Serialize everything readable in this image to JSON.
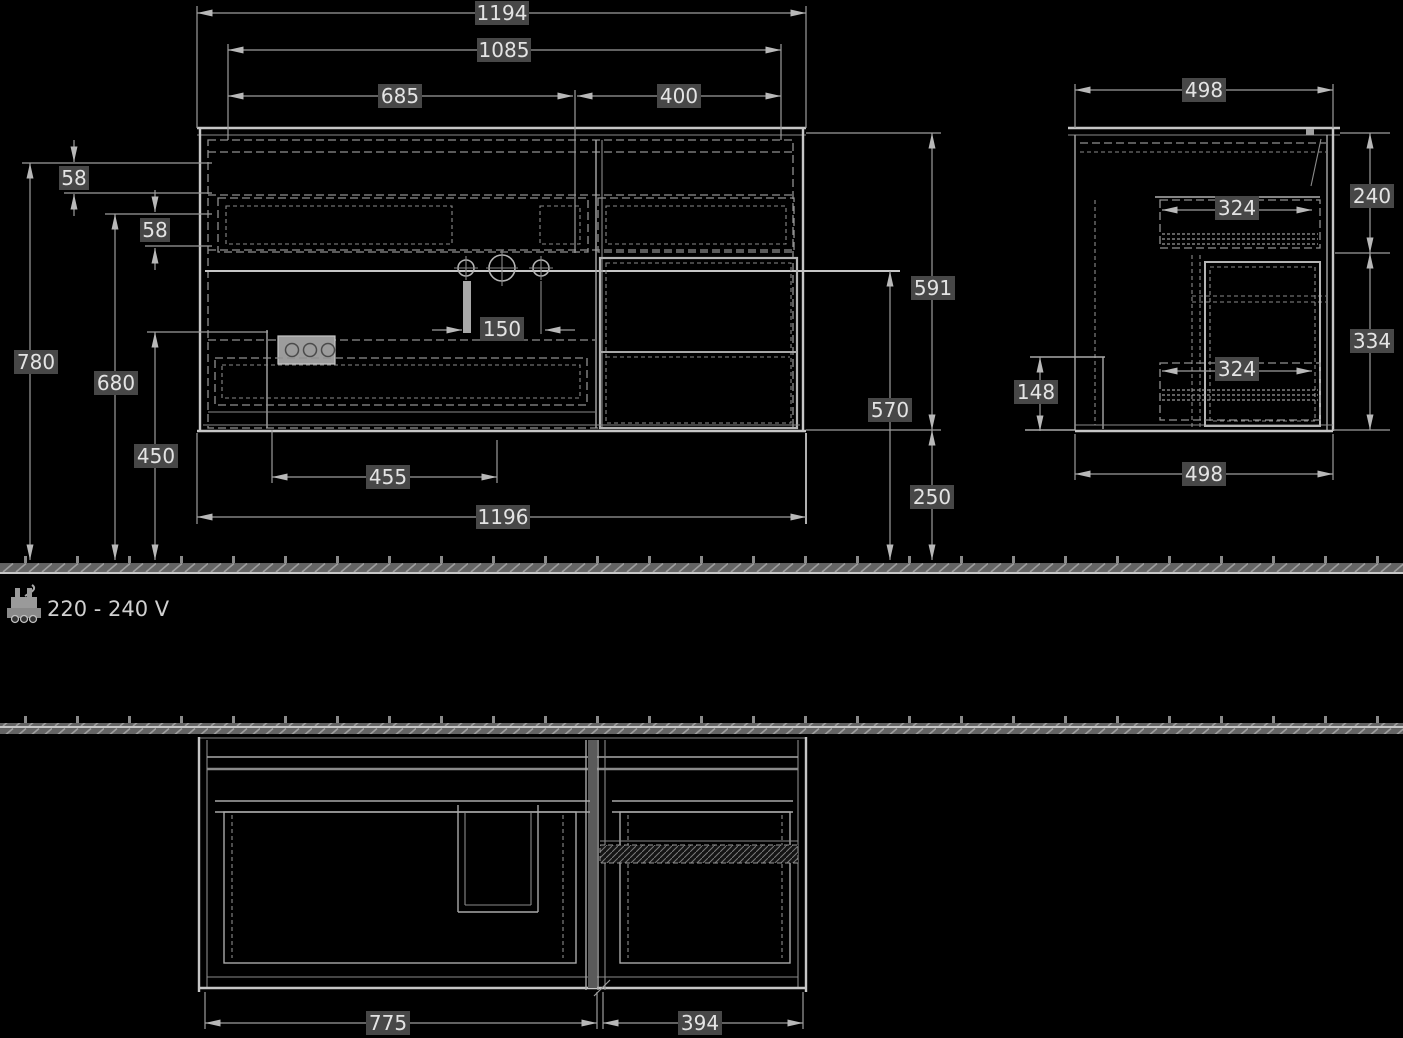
{
  "front_view": {
    "dims": {
      "overall_width_top": "1194",
      "basin_width": "1085",
      "left_unit_width": "685",
      "right_unit_width": "400",
      "top_rim_offset": "58",
      "rail_offset": "58",
      "height_overall": "780",
      "height_front_edge": "680",
      "height_shelf": "450",
      "tap_hole_spacing": "150",
      "shelf_width": "455",
      "cabinet_width_bottom": "1196",
      "cabinet_height": "591",
      "height_under_basin": "570",
      "floor_clearance": "250"
    }
  },
  "side_view": {
    "dims": {
      "depth_top": "498",
      "upper_section_height": "240",
      "upper_drawer_depth": "324",
      "lower_section_height": "334",
      "front_recess_height": "148",
      "lower_drawer_depth": "324",
      "depth_bottom": "498"
    }
  },
  "plan_view": {
    "dims": {
      "left_compartment_width": "775",
      "right_compartment_width": "394"
    }
  },
  "notes": {
    "voltage": "220 - 240 V"
  },
  "colors": {
    "background": "#000000",
    "line": "#a8a8a8",
    "line_bright": "#c6c6c6",
    "line_dashed": "#8f8f8f",
    "label_bg": "#474747",
    "label_text": "#e4e4e4"
  }
}
